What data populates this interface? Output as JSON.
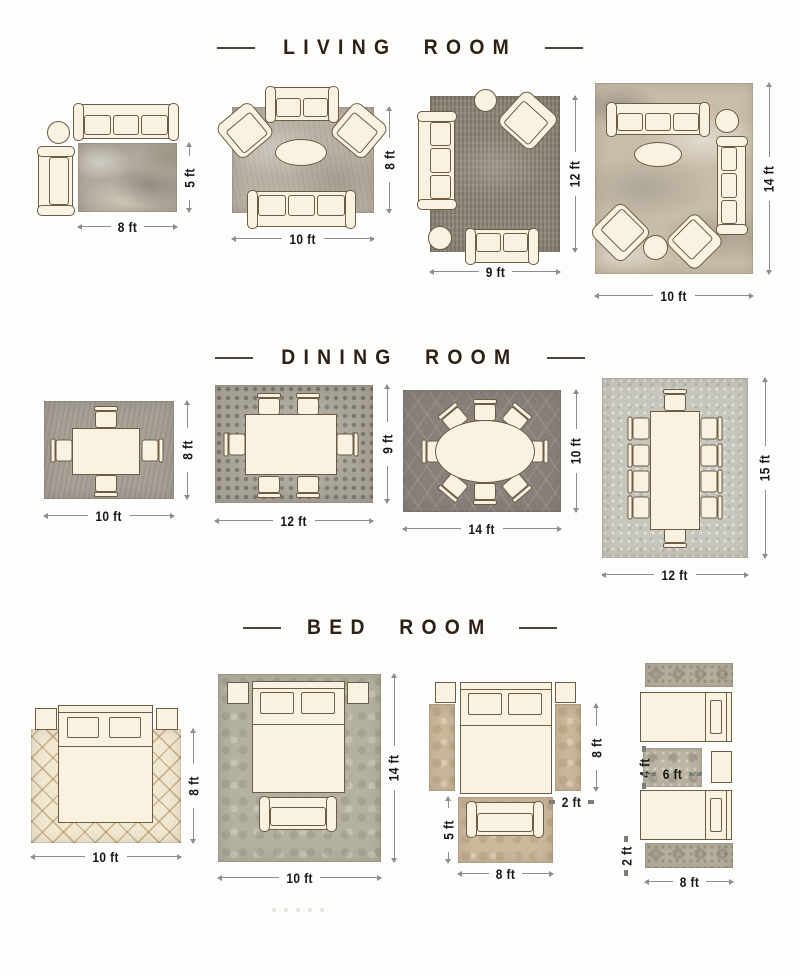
{
  "sections": {
    "living": {
      "title": "LIVING ROOM",
      "layouts": [
        {
          "name": "sofa-chaise-side-table",
          "width": "8 ft",
          "height": "5 ft"
        },
        {
          "name": "sofa-two-armchairs-coffee-table",
          "width": "10 ft",
          "height": "8 ft"
        },
        {
          "name": "sofa-loveseat-armchair-ottoman",
          "width": "9 ft",
          "height": "12 ft"
        },
        {
          "name": "two-sofas-two-armchairs-tables",
          "width": "10 ft",
          "height": "14 ft"
        }
      ]
    },
    "dining": {
      "title": "DINING ROOM",
      "layouts": [
        {
          "name": "square-table-4-chairs",
          "width": "10 ft",
          "height": "8 ft"
        },
        {
          "name": "rect-table-6-chairs",
          "width": "12 ft",
          "height": "9 ft"
        },
        {
          "name": "oval-table-8-chairs",
          "width": "14 ft",
          "height": "10 ft"
        },
        {
          "name": "long-table-10-chairs",
          "width": "12 ft",
          "height": "15 ft"
        }
      ]
    },
    "bed": {
      "title": "BED ROOM",
      "layouts": [
        {
          "name": "bed-on-rug",
          "width": "10 ft",
          "height": "8 ft"
        },
        {
          "name": "bed-nightstands-bench-on-rug",
          "width": "10 ft",
          "height": "14 ft"
        },
        {
          "name": "bed-with-side-runners-and-foot-rug",
          "side_rug_height": "8 ft",
          "side_rug_width": "2 ft",
          "foot_rug_height": "5 ft",
          "foot_rug_width": "8 ft"
        },
        {
          "name": "twin-beds-with-runners-and-mid-rug",
          "mid_rug_height": "4 ft",
          "mid_rug_width": "6 ft",
          "runner_height": "2 ft",
          "runner_width": "8 ft"
        }
      ]
    }
  },
  "colors": {
    "background": "#fdfdfb",
    "title_text": "#2e2014",
    "dimension_text": "#171716",
    "dimension_line": "#8e8e8c",
    "furniture_fill": "#faf2e1",
    "furniture_outline": "#6c5b45",
    "rug_grey": "#b1aa9c",
    "rug_dark_grey": "#87807a",
    "rug_cream_lattice": "#f1e8d2",
    "rug_sage": "#b4b1a0",
    "rug_tan": "#ccb99c"
  }
}
